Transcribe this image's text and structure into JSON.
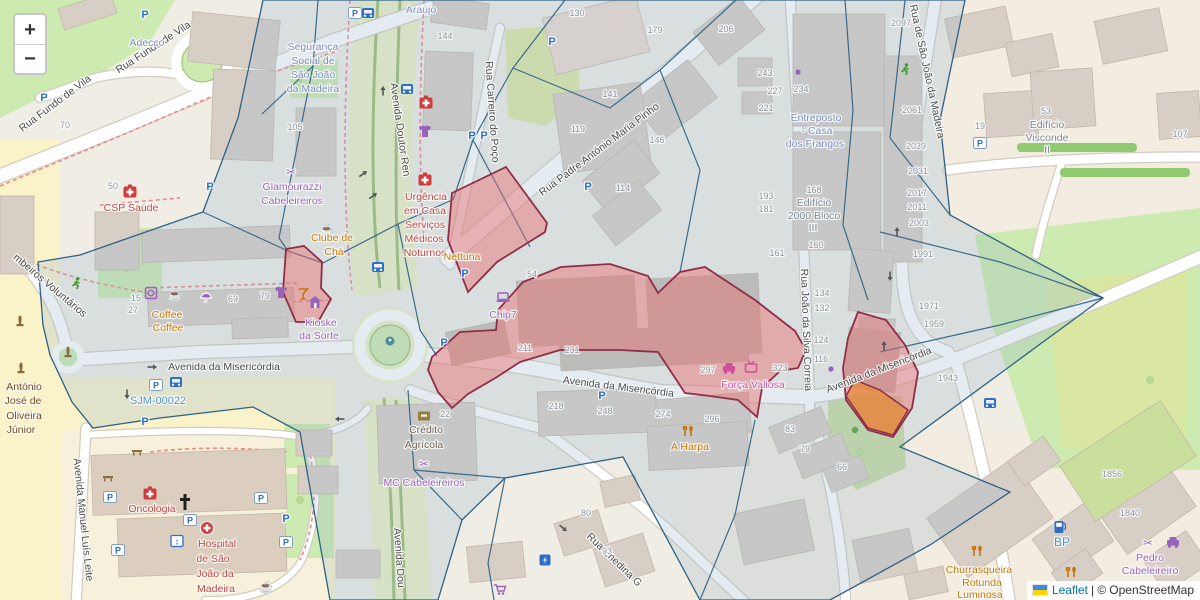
{
  "controls": {
    "zoom_in": "+",
    "zoom_out": "−"
  },
  "attribution": {
    "leaflet": "Leaflet",
    "separator": "| ©",
    "copyright": "OpenStreetMap"
  },
  "colors": {
    "street": "#4c4c4c",
    "housenumber": "#8b959e",
    "office": "#7b8cc0",
    "health": "#c0443f",
    "shop": "#9a63bb",
    "food": "#c77400",
    "brand_pink": "#d0509e",
    "historic": "#73491c",
    "bank_label": "#6f6257",
    "building_label": "#7d8893",
    "ref_blue": "#4f94cd",
    "overlay_stroke": "#2e6286",
    "overlay_fill": "rgba(146,178,203,0.25)",
    "zone_fill": "rgba(234,109,109,0.45)",
    "zone_stroke": "#8e2f47",
    "zone_orange": "rgba(230,140,60,0.78)",
    "blue_icon": "#2f6ec4",
    "red_icon": "#cf3d3d",
    "purple_icon": "#9a63bb",
    "pink_icon": "#d0509e",
    "orange_icon": "#c77400",
    "green_icon": "#3f9b2e",
    "brown_icon": "#8a6d3b",
    "arrow_icon": "#555555"
  },
  "streets": [
    [
      "Rua Fundo de Vila",
      57,
      106,
      -37
    ],
    [
      "Rua Fundo de Vila",
      155,
      50,
      -33
    ],
    [
      "Avenida Doutor Ren",
      397,
      130,
      82
    ],
    [
      "Rua Carreiro do Poço",
      489,
      112,
      86
    ],
    [
      "Rua Padre António Maria Pinho",
      601,
      152,
      -37
    ],
    [
      "Rua de São João da Madeira",
      924,
      72,
      78
    ],
    [
      "Rua João da Silva Correia",
      803,
      330,
      88
    ],
    [
      "Avenida da Misericórdia",
      224,
      370,
      0
    ],
    [
      "Avenida da Misericórdia",
      618,
      390,
      7
    ],
    [
      "Avenida da Misericórdia",
      880,
      373,
      -21
    ],
    [
      "Avenida Manuel Luís Leite",
      80,
      520,
      84
    ],
    [
      "Rua Enedina G",
      612,
      562,
      44
    ],
    [
      "mbeiros Voluntários",
      48,
      288,
      40
    ],
    [
      "Avenida Dou",
      396,
      558,
      86
    ],
    [
      "SJM-00022",
      158,
      404,
      0,
      "ref_blue",
      11
    ]
  ],
  "pois": [
    [
      "Adecco",
      147,
      46,
      "office"
    ],
    [
      "Segurança",
      313,
      50,
      "office"
    ],
    [
      "Social de",
      313,
      64,
      "office"
    ],
    [
      "São João",
      313,
      78,
      "office"
    ],
    [
      "da Madeira",
      313,
      92,
      "office"
    ],
    [
      "Araújo",
      421,
      13,
      "office"
    ],
    [
      "CSP Saúde",
      131,
      211,
      "health"
    ],
    [
      "Glamourazzi",
      292,
      190,
      "shop"
    ],
    [
      "Cabeleireiros",
      292,
      204,
      "shop"
    ],
    [
      "Clube de",
      332,
      241,
      "food"
    ],
    [
      "Chá",
      334,
      255,
      "food"
    ],
    [
      "Coffee",
      167,
      318,
      "food"
    ],
    [
      "Coffee",
      168,
      331,
      "food"
    ],
    [
      "Kioske",
      321,
      326,
      "shop"
    ],
    [
      "da Sorte",
      319,
      339,
      "shop"
    ],
    [
      "Urgência",
      426,
      200,
      "health"
    ],
    [
      "em Casa",
      425,
      214,
      "health"
    ],
    [
      "Serviços",
      425,
      228,
      "health"
    ],
    [
      "Médicos",
      424,
      242,
      "health"
    ],
    [
      "Noturnos",
      425,
      256,
      "health"
    ],
    [
      "Nettuna",
      462,
      260,
      "food"
    ],
    [
      "Chip7",
      503,
      318,
      "shop"
    ],
    [
      "Força Valiosa",
      753,
      388,
      "brand_pink"
    ],
    [
      "A Harpa",
      690,
      450,
      "food"
    ],
    [
      "Crédito",
      426,
      433,
      "bank_label"
    ],
    [
      "Agrícola",
      424,
      448,
      "bank_label"
    ],
    [
      "MC Cabeleireiros",
      424,
      486,
      "shop"
    ],
    [
      "Oncologia",
      152,
      512,
      "health"
    ],
    [
      "Hospital",
      217,
      547,
      "health"
    ],
    [
      "de São",
      213,
      562,
      "health"
    ],
    [
      "João da",
      215,
      577,
      "health"
    ],
    [
      "Madeira",
      216,
      592,
      "health"
    ],
    [
      "António",
      24,
      390,
      "historic"
    ],
    [
      "José de",
      23,
      404,
      "historic"
    ],
    [
      "Oliveira",
      24,
      419,
      "historic"
    ],
    [
      "Júnior",
      21,
      433,
      "historic"
    ],
    [
      "Entreposto",
      816,
      121,
      "office"
    ],
    [
      "- Casa",
      817,
      134,
      "office"
    ],
    [
      "dos Frangos",
      815,
      147,
      "office"
    ],
    [
      "Edifício",
      814,
      206,
      "building_label"
    ],
    [
      "2000 Bloco",
      814,
      219,
      "building_label"
    ],
    [
      "III",
      813,
      231,
      "building_label"
    ],
    [
      "Edifício",
      1047,
      128,
      "building_label"
    ],
    [
      "Visconde",
      1047,
      141,
      "building_label"
    ],
    [
      "II",
      1047,
      153,
      "building_label"
    ],
    [
      "Churrasqueira",
      979,
      573,
      "food"
    ],
    [
      "Rotunda",
      982,
      586,
      "food"
    ],
    [
      "Luminosa",
      980,
      598,
      "food"
    ],
    [
      "BP",
      1062,
      546,
      "ref_blue",
      12
    ],
    [
      "Pedro",
      1150,
      561,
      "shop"
    ],
    [
      "Cabeleireiro",
      1150,
      574,
      "shop"
    ]
  ],
  "housenumbers": [
    [
      "70",
      65,
      128
    ],
    [
      "105",
      295,
      130
    ],
    [
      "50",
      113,
      189
    ],
    [
      "144",
      445,
      39
    ],
    [
      "130",
      577,
      16
    ],
    [
      "179",
      655,
      33
    ],
    [
      "206",
      726,
      32
    ],
    [
      "141",
      610,
      97
    ],
    [
      "119",
      578,
      132
    ],
    [
      "146",
      657,
      143
    ],
    [
      "114",
      623,
      191
    ],
    [
      "54",
      532,
      277
    ],
    [
      "15",
      136,
      301
    ],
    [
      "27",
      133,
      313
    ],
    [
      "69",
      233,
      302
    ],
    [
      "79",
      265,
      299
    ],
    [
      "211",
      525,
      351
    ],
    [
      "231",
      572,
      353
    ],
    [
      "218",
      556,
      409
    ],
    [
      "248",
      605,
      414
    ],
    [
      "274",
      663,
      417
    ],
    [
      "296",
      712,
      422
    ],
    [
      "297",
      708,
      373
    ],
    [
      "323",
      780,
      371
    ],
    [
      "83",
      790,
      432
    ],
    [
      "79",
      805,
      452
    ],
    [
      "66",
      842,
      470
    ],
    [
      "80",
      586,
      516
    ],
    [
      "93",
      607,
      554
    ],
    [
      "22",
      445,
      417
    ],
    [
      "243",
      765,
      76
    ],
    [
      "227",
      775,
      94
    ],
    [
      "234",
      801,
      92
    ],
    [
      "221",
      766,
      111
    ],
    [
      "2097",
      901,
      26
    ],
    [
      "2061",
      912,
      113
    ],
    [
      "2039",
      916,
      149
    ],
    [
      "2031",
      918,
      174
    ],
    [
      "2017",
      917,
      196
    ],
    [
      "2011",
      917,
      210
    ],
    [
      "2003",
      919,
      226
    ],
    [
      "1991",
      923,
      257
    ],
    [
      "1971",
      929,
      309
    ],
    [
      "1959",
      934,
      327
    ],
    [
      "1943",
      948,
      381
    ],
    [
      "193",
      766,
      199
    ],
    [
      "181",
      766,
      212
    ],
    [
      "168",
      814,
      193
    ],
    [
      "160",
      816,
      248
    ],
    [
      "161",
      777,
      256
    ],
    [
      "134",
      822,
      296
    ],
    [
      "132",
      822,
      311
    ],
    [
      "124",
      821,
      343
    ],
    [
      "116",
      821,
      362
    ],
    [
      "19",
      980,
      129
    ],
    [
      "53",
      1046,
      114
    ],
    [
      "107",
      1180,
      137
    ],
    [
      "1856",
      1112,
      477
    ],
    [
      "1840",
      1130,
      516
    ]
  ],
  "icons": [
    [
      "parking",
      145,
      14
    ],
    [
      "parking",
      44,
      97
    ],
    [
      "parking",
      210,
      186
    ],
    [
      "parking",
      472,
      135
    ],
    [
      "parking",
      484,
      135
    ],
    [
      "parking",
      552,
      41
    ],
    [
      "parking",
      588,
      186
    ],
    [
      "parking",
      465,
      273
    ],
    [
      "parking",
      444,
      342
    ],
    [
      "parking",
      602,
      395
    ],
    [
      "parking",
      286,
      518
    ],
    [
      "parking",
      145,
      421
    ],
    [
      "parking-lot",
      980,
      143
    ],
    [
      "parking-lot",
      110,
      497
    ],
    [
      "parking-lot",
      118,
      550
    ],
    [
      "parking-lot",
      190,
      520
    ],
    [
      "parking-lot",
      261,
      498
    ],
    [
      "parking-lot",
      286,
      542
    ],
    [
      "parking-lot",
      156,
      385
    ],
    [
      "parking-lot",
      355,
      13
    ],
    [
      "bus-stop",
      407,
      89
    ],
    [
      "bus-stop",
      378,
      267
    ],
    [
      "bus-stop",
      176,
      382
    ],
    [
      "bus-stop",
      990,
      403
    ],
    [
      "bus-stop",
      368,
      13
    ],
    [
      "first-aid",
      130,
      192
    ],
    [
      "first-aid",
      426,
      103
    ],
    [
      "first-aid",
      425,
      180
    ],
    [
      "first-aid",
      150,
      494
    ],
    [
      "hospital",
      207,
      528
    ],
    [
      "cross",
      185,
      502
    ],
    [
      "cafe",
      175,
      295
    ],
    [
      "cafe",
      327,
      230
    ],
    [
      "cafe",
      266,
      587
    ],
    [
      "restaurant",
      688,
      431
    ],
    [
      "restaurant",
      977,
      551
    ],
    [
      "restaurant",
      1071,
      572
    ],
    [
      "bar",
      303,
      294
    ],
    [
      "hairdresser",
      291,
      172
    ],
    [
      "hairdresser",
      424,
      464
    ],
    [
      "hairdresser",
      1148,
      543
    ],
    [
      "car",
      1173,
      543,
      0,
      "purple_icon"
    ],
    [
      "car",
      729,
      369,
      0,
      "pink_icon"
    ],
    [
      "electronics",
      751,
      368
    ],
    [
      "computer-shop",
      503,
      298
    ],
    [
      "kiosk",
      315,
      303
    ],
    [
      "clothes-shop",
      425,
      132
    ],
    [
      "clothes-shop",
      281,
      293
    ],
    [
      "laundry",
      151,
      293
    ],
    [
      "umbrella",
      206,
      298
    ],
    [
      "supermarket",
      500,
      590
    ],
    [
      "fuel-station",
      1060,
      527
    ],
    [
      "charging-station",
      545,
      560
    ],
    [
      "elevator",
      177,
      541
    ],
    [
      "monument",
      20,
      325
    ],
    [
      "monument",
      21,
      372
    ],
    [
      "monument",
      68,
      356
    ],
    [
      "fountain",
      390,
      341
    ],
    [
      "sports",
      905,
      70
    ],
    [
      "sports",
      76,
      284
    ],
    [
      "tree-dot",
      855,
      430
    ],
    [
      "shop-dot",
      831,
      369
    ],
    [
      "shop-dot",
      798,
      72
    ],
    [
      "bench",
      137,
      452
    ],
    [
      "bench",
      108,
      478
    ],
    [
      "bank",
      424,
      416
    ],
    [
      "oneway-arrow",
      152,
      367,
      0
    ],
    [
      "oneway-arrow",
      363,
      174,
      -35
    ],
    [
      "oneway-arrow",
      373,
      196,
      -35
    ],
    [
      "oneway-arrow",
      383,
      91,
      -90
    ],
    [
      "oneway-arrow",
      897,
      232,
      -90
    ],
    [
      "oneway-arrow",
      890,
      276,
      90
    ],
    [
      "oneway-arrow",
      563,
      528,
      40
    ],
    [
      "oneway-arrow",
      127,
      394,
      90
    ],
    [
      "oneway-arrow",
      340,
      419,
      180
    ],
    [
      "oneway-arrow",
      884,
      346,
      -90
    ]
  ]
}
